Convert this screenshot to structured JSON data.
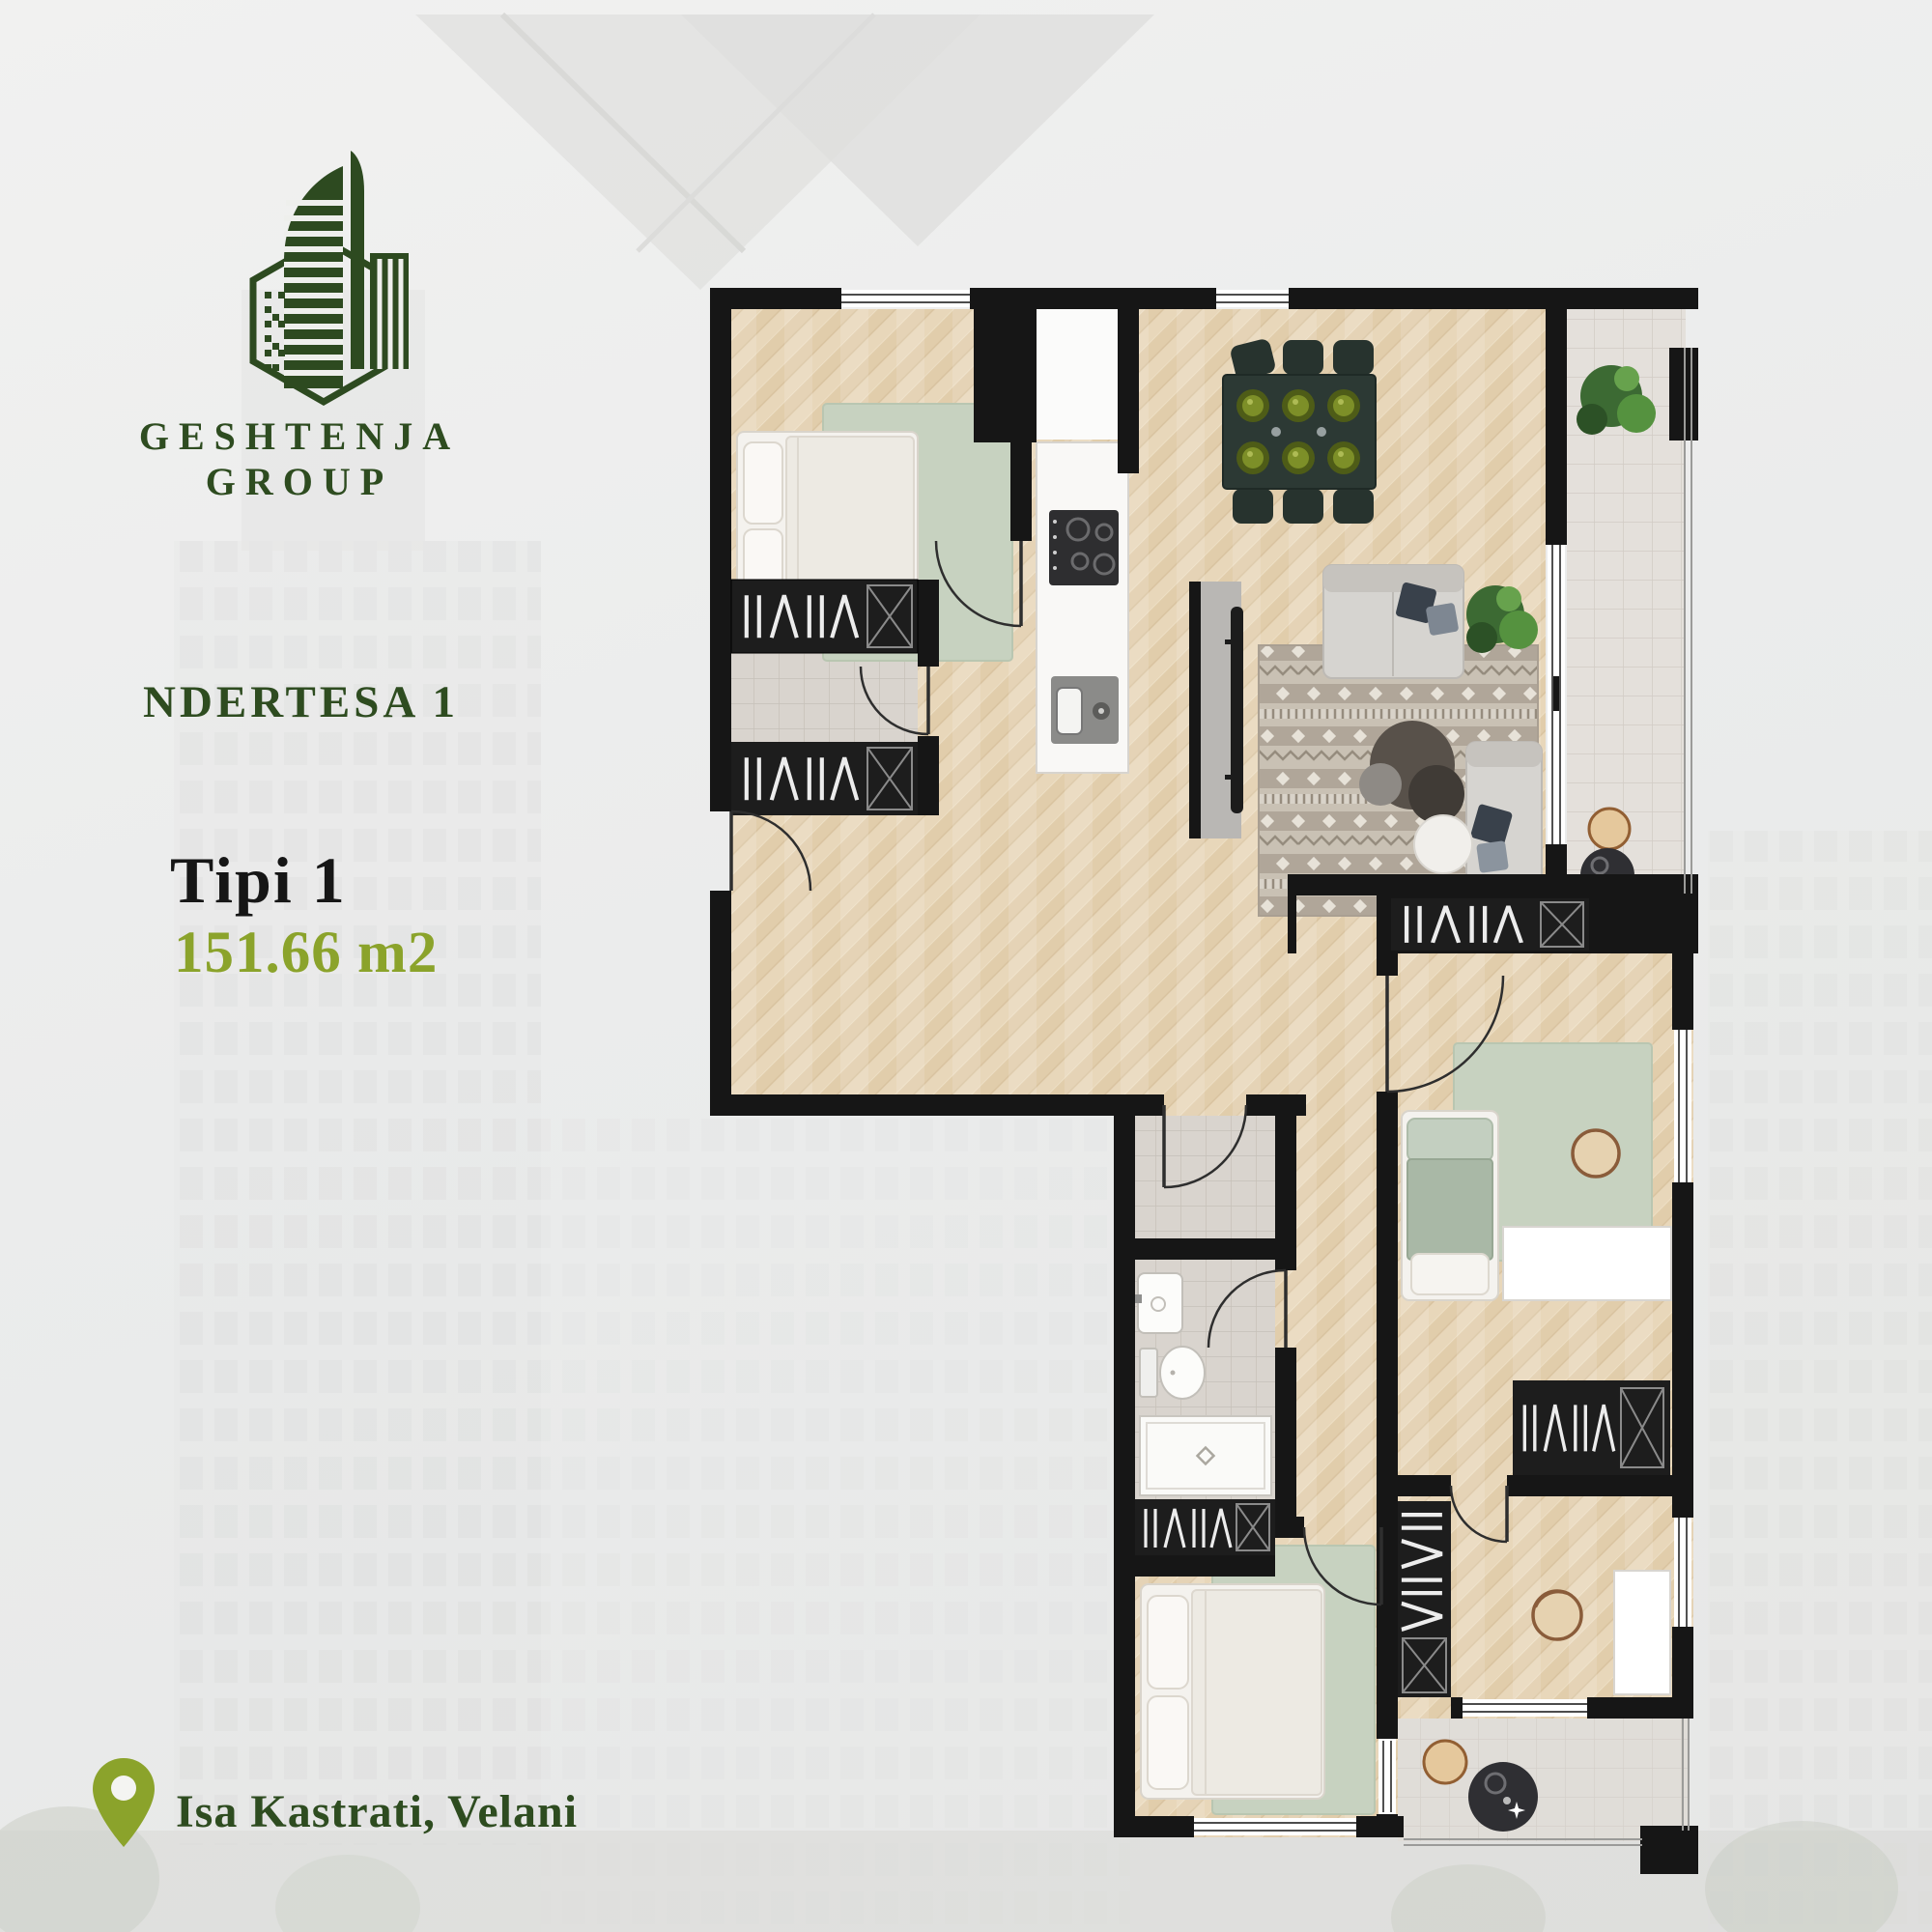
{
  "brand": {
    "name": "GESHTENJA GROUP",
    "logo_icon": "building-hexagon-logo",
    "logo_color": "#2d4a20"
  },
  "listing": {
    "building_label": "NDERTESA 1",
    "type_label": "Tipi 1",
    "area_label": "151.66 m2",
    "location": "Isa Kastrati, Velani",
    "location_icon": "map-pin-icon"
  },
  "palette": {
    "dark_green": "#2e4c20",
    "olive_green": "#8ba32b",
    "black_text": "#161616",
    "wall": "#161616",
    "wood_floor": "#e8d7ba",
    "sage_rug": "#c7d2c0",
    "tile_gray": "#dbd6d0",
    "balcony_tile": "#e3dfda",
    "background": "#ebecec"
  },
  "floor_plan": {
    "type": "apartment-floor-plan",
    "rooms": [
      "master-bedroom",
      "walk-in-closet",
      "kitchen",
      "dining-area",
      "living-room",
      "balcony",
      "hallway",
      "wc",
      "bathroom",
      "kids-bedroom",
      "second-bedroom",
      "study-room",
      "terrace"
    ],
    "furniture": [
      "double-bed",
      "area-rug",
      "wardrobe",
      "kitchen-counter",
      "cooktop",
      "kitchen-sink",
      "dining-table-six-seats",
      "tv-panel",
      "sofa",
      "armchair",
      "coffee-tables",
      "plants",
      "balcony-chairs",
      "balcony-table",
      "wash-basin",
      "toilet",
      "shower-tray",
      "single-bed",
      "desk",
      "round-chair",
      "terrace-table"
    ]
  }
}
